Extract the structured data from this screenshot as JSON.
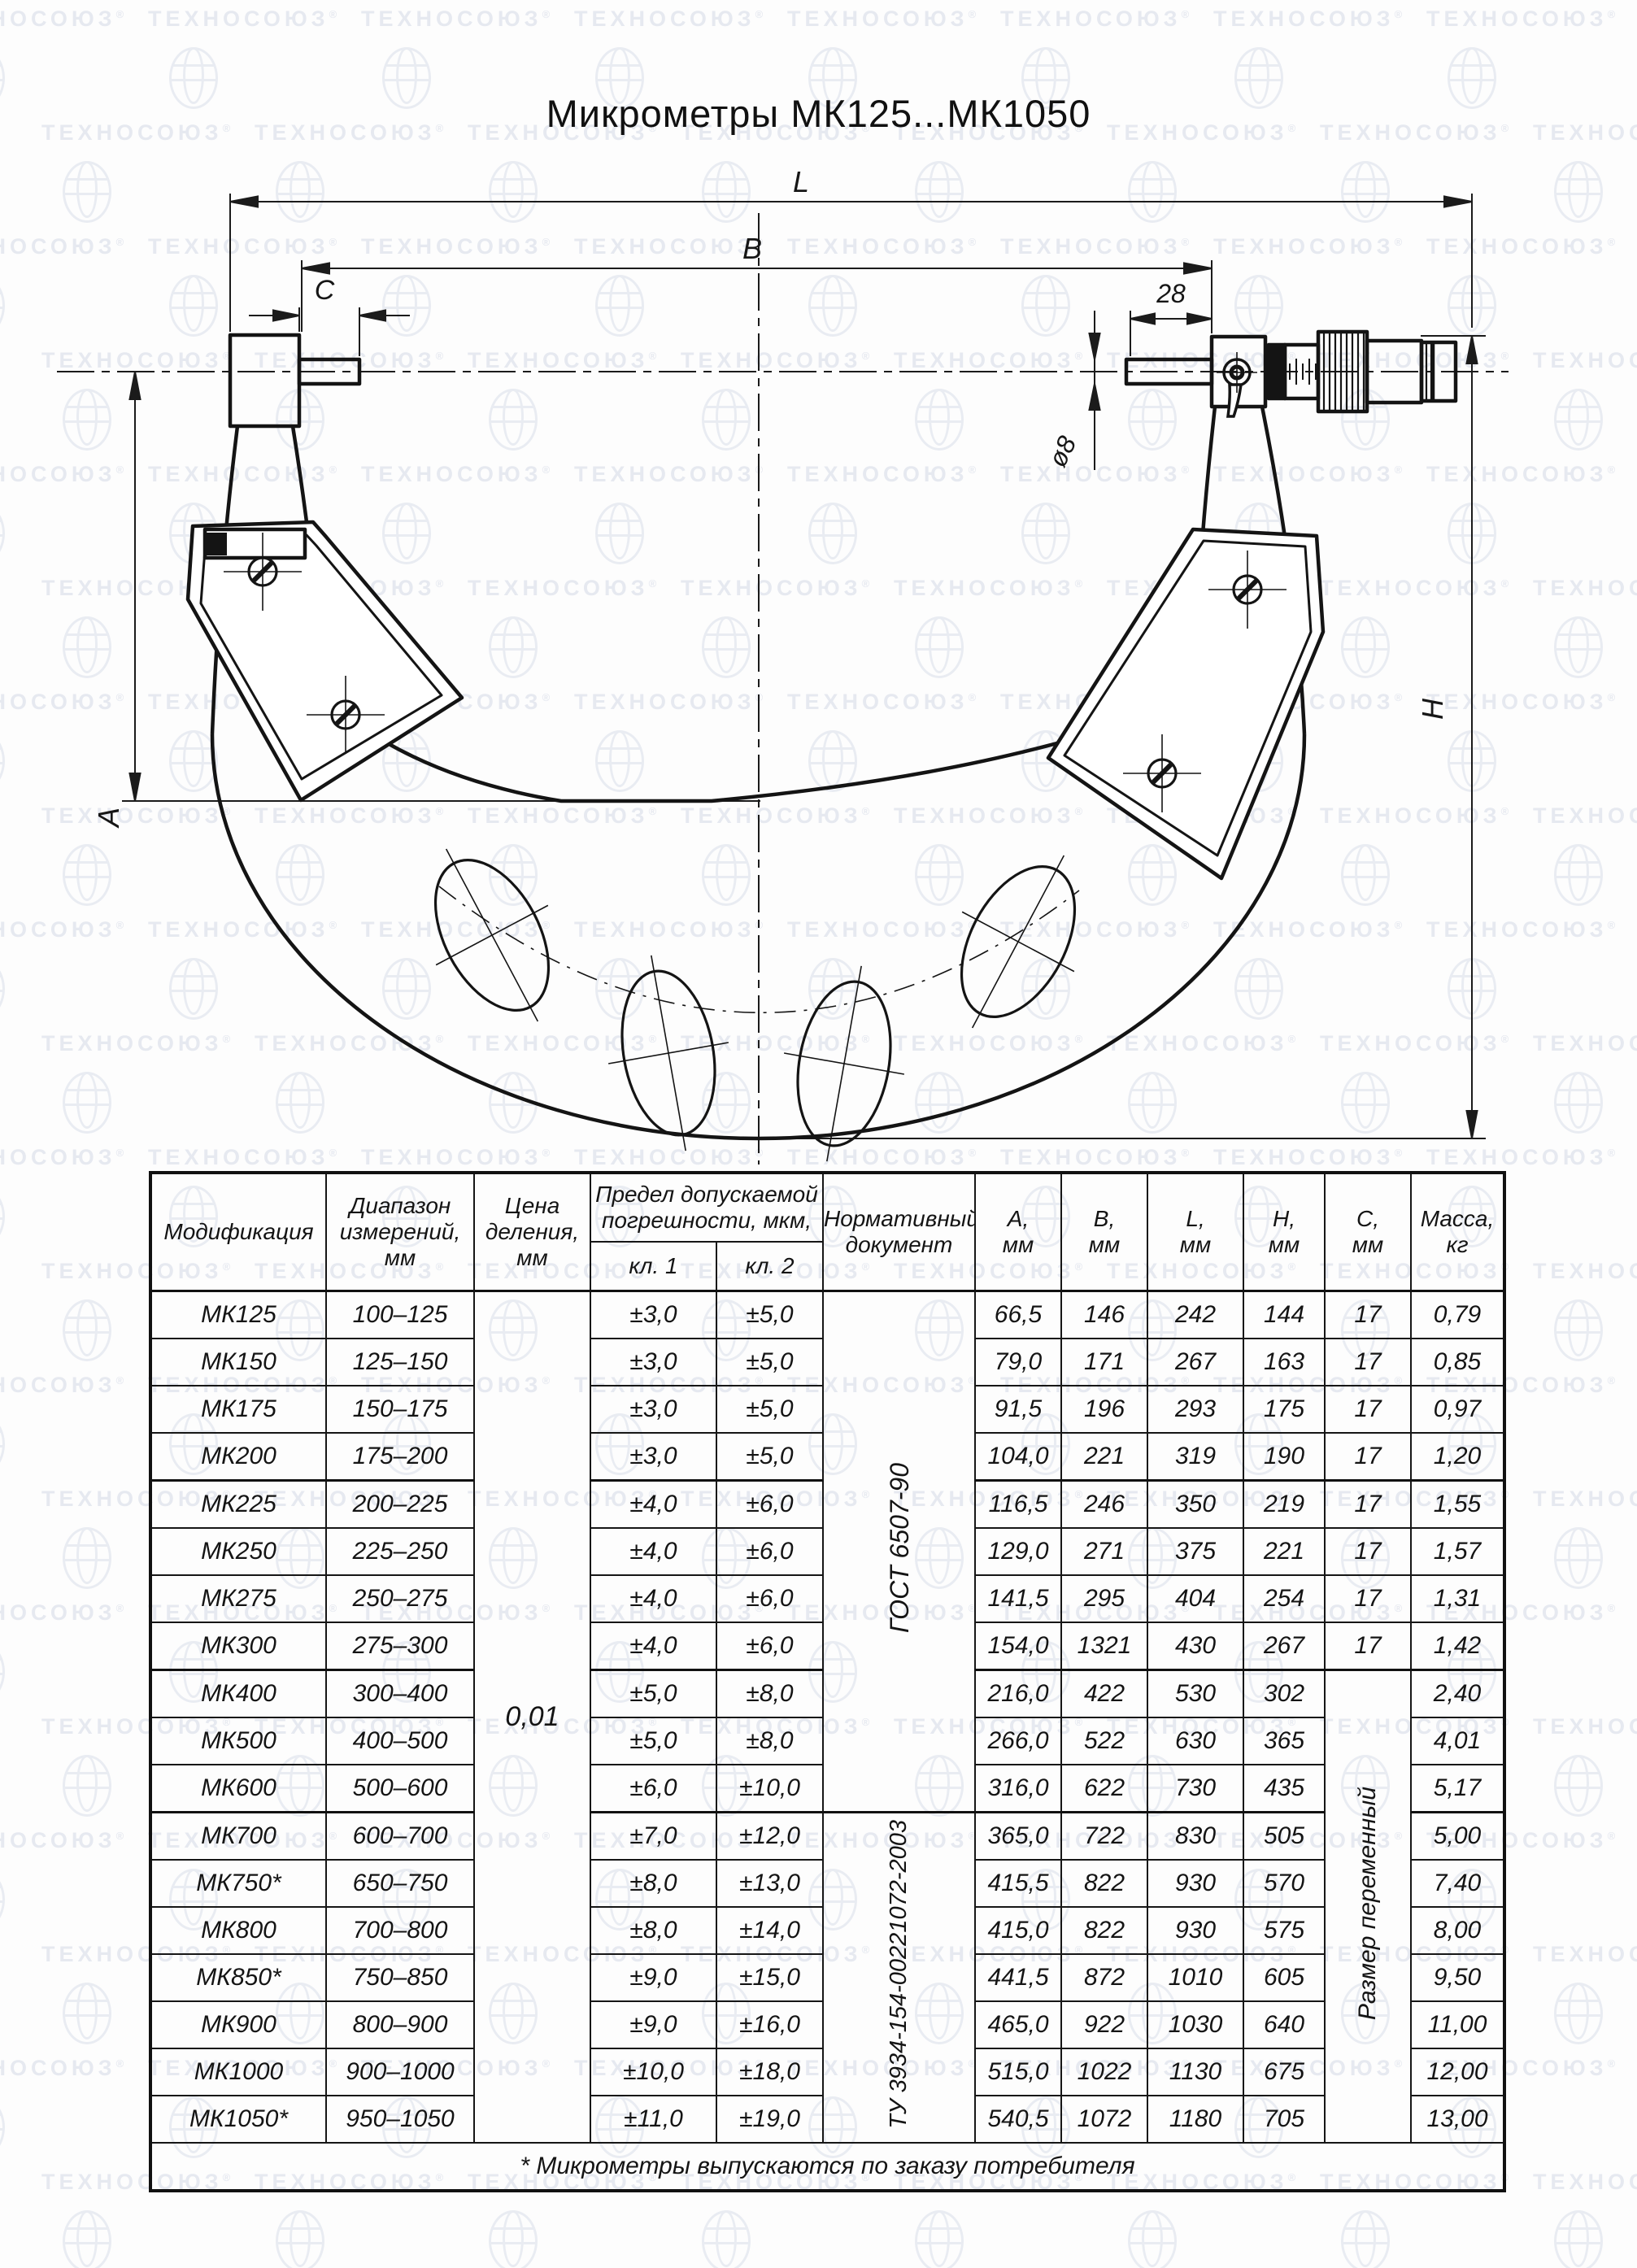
{
  "watermark": {
    "text": "ТЕХНОСОЮЗ",
    "reg": "®"
  },
  "title": "Микрометры МК125...МК1050",
  "drawing": {
    "labels": {
      "L": "L",
      "B": "B",
      "C": "C",
      "len28": "28",
      "dia8": "ø8",
      "A": "А",
      "H": "Н"
    }
  },
  "table": {
    "headers": {
      "modification": "Модификация",
      "range": "Диапазон\nизмерений,\nмм",
      "price_division": "Цена\nделения,\nмм",
      "error_limit": "Предел допускаемой\nпогрешности, мкм,",
      "kl1": "кл. 1",
      "kl2": "кл. 2",
      "document": "Нормативный\nдокумент",
      "a": "А,\nмм",
      "b": "В,\nмм",
      "l": "L,\nмм",
      "h": "Н,\nмм",
      "c": "С,\nмм",
      "mass": "Масса,\nкг"
    },
    "price_division": "0,01",
    "doc_gost": "ГОСТ 6507-90",
    "doc_tu": "ТУ 3934-154-00221072-2003",
    "c_variable": "Размер переменный",
    "rows": [
      {
        "mod": "МК125",
        "range": "100–125",
        "kl1": "±3,0",
        "kl2": "±5,0",
        "a": "66,5",
        "b": "146",
        "l": "242",
        "h": "144",
        "c": "17",
        "mass": "0,79"
      },
      {
        "mod": "МК150",
        "range": "125–150",
        "kl1": "±3,0",
        "kl2": "±5,0",
        "a": "79,0",
        "b": "171",
        "l": "267",
        "h": "163",
        "c": "17",
        "mass": "0,85"
      },
      {
        "mod": "МК175",
        "range": "150–175",
        "kl1": "±3,0",
        "kl2": "±5,0",
        "a": "91,5",
        "b": "196",
        "l": "293",
        "h": "175",
        "c": "17",
        "mass": "0,97"
      },
      {
        "mod": "МК200",
        "range": "175–200",
        "kl1": "±3,0",
        "kl2": "±5,0",
        "a": "104,0",
        "b": "221",
        "l": "319",
        "h": "190",
        "c": "17",
        "mass": "1,20"
      },
      {
        "mod": "МК225",
        "range": "200–225",
        "kl1": "±4,0",
        "kl2": "±6,0",
        "a": "116,5",
        "b": "246",
        "l": "350",
        "h": "219",
        "c": "17",
        "mass": "1,55"
      },
      {
        "mod": "МК250",
        "range": "225–250",
        "kl1": "±4,0",
        "kl2": "±6,0",
        "a": "129,0",
        "b": "271",
        "l": "375",
        "h": "221",
        "c": "17",
        "mass": "1,57"
      },
      {
        "mod": "МК275",
        "range": "250–275",
        "kl1": "±4,0",
        "kl2": "±6,0",
        "a": "141,5",
        "b": "295",
        "l": "404",
        "h": "254",
        "c": "17",
        "mass": "1,31"
      },
      {
        "mod": "МК300",
        "range": "275–300",
        "kl1": "±4,0",
        "kl2": "±6,0",
        "a": "154,0",
        "b": "1321",
        "l": "430",
        "h": "267",
        "c": "17",
        "mass": "1,42"
      },
      {
        "mod": "МК400",
        "range": "300–400",
        "kl1": "±5,0",
        "kl2": "±8,0",
        "a": "216,0",
        "b": "422",
        "l": "530",
        "h": "302",
        "c": "",
        "mass": "2,40"
      },
      {
        "mod": "МК500",
        "range": "400–500",
        "kl1": "±5,0",
        "kl2": "±8,0",
        "a": "266,0",
        "b": "522",
        "l": "630",
        "h": "365",
        "c": "",
        "mass": "4,01"
      },
      {
        "mod": "МК600",
        "range": "500–600",
        "kl1": "±6,0",
        "kl2": "±10,0",
        "a": "316,0",
        "b": "622",
        "l": "730",
        "h": "435",
        "c": "",
        "mass": "5,17"
      },
      {
        "mod": "МК700",
        "range": "600–700",
        "kl1": "±7,0",
        "kl2": "±12,0",
        "a": "365,0",
        "b": "722",
        "l": "830",
        "h": "505",
        "c": "",
        "mass": "5,00"
      },
      {
        "mod": "МК750*",
        "range": "650–750",
        "kl1": "±8,0",
        "kl2": "±13,0",
        "a": "415,5",
        "b": "822",
        "l": "930",
        "h": "570",
        "c": "",
        "mass": "7,40"
      },
      {
        "mod": "МК800",
        "range": "700–800",
        "kl1": "±8,0",
        "kl2": "±14,0",
        "a": "415,0",
        "b": "822",
        "l": "930",
        "h": "575",
        "c": "",
        "mass": "8,00"
      },
      {
        "mod": "МК850*",
        "range": "750–850",
        "kl1": "±9,0",
        "kl2": "±15,0",
        "a": "441,5",
        "b": "872",
        "l": "1010",
        "h": "605",
        "c": "",
        "mass": "9,50"
      },
      {
        "mod": "МК900",
        "range": "800–900",
        "kl1": "±9,0",
        "kl2": "±16,0",
        "a": "465,0",
        "b": "922",
        "l": "1030",
        "h": "640",
        "c": "",
        "mass": "11,00"
      },
      {
        "mod": "МК1000",
        "range": "900–1000",
        "kl1": "±10,0",
        "kl2": "±18,0",
        "a": "515,0",
        "b": "1022",
        "l": "1130",
        "h": "675",
        "c": "",
        "mass": "12,00"
      },
      {
        "mod": "МК1050*",
        "range": "950–1050",
        "kl1": "±11,0",
        "kl2": "±19,0",
        "a": "540,5",
        "b": "1072",
        "l": "1180",
        "h": "705",
        "c": "",
        "mass": "13,00"
      }
    ],
    "footnote": "* Микрометры выпускаются по заказу потребителя"
  }
}
